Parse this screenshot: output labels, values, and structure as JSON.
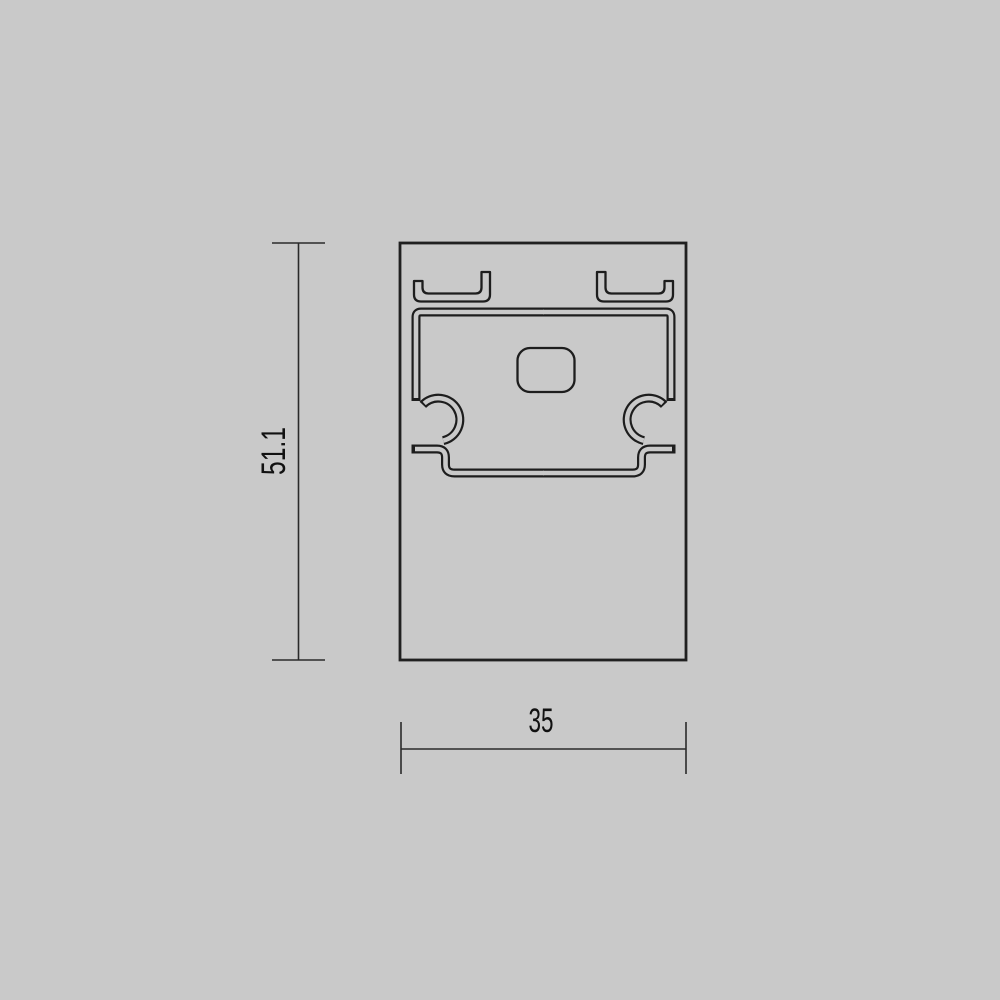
{
  "drawing": {
    "colors": {
      "background": "#c9c9c9",
      "profile_line": "#1d1d1d",
      "dimension_line": "#2a2a2a",
      "text": "#111111"
    },
    "dimensions": {
      "height": {
        "label": "51.1"
      },
      "width": {
        "label": "35"
      }
    }
  }
}
